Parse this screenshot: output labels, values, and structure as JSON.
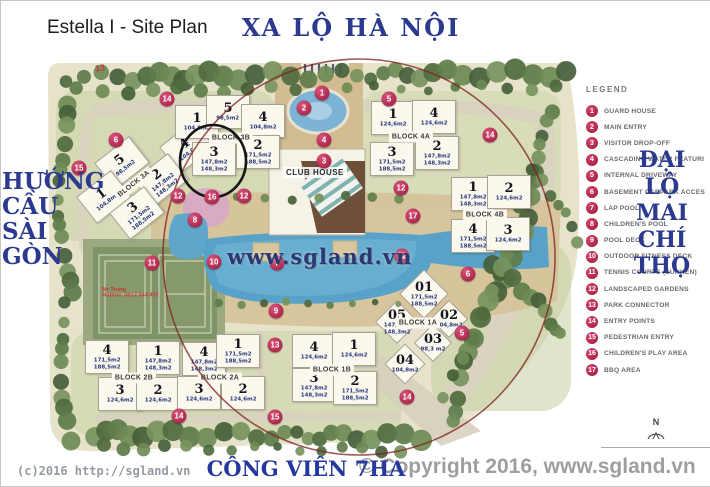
{
  "header": {
    "title": "Estella I - Site Plan",
    "road_top": "XA LỘ HÀ NỘI"
  },
  "sides": {
    "left_lines": [
      "HƯỚNG",
      "CẦU",
      "SÀI",
      "GÒN"
    ],
    "right_lines": [
      "ĐẠI",
      "LỘ",
      "MAI",
      "CHÍ",
      "THỌ"
    ]
  },
  "legend": {
    "title": "LEGEND",
    "items": [
      {
        "num": "1",
        "label": "GUARD HOUSE"
      },
      {
        "num": "2",
        "label": "MAIN ENTRY"
      },
      {
        "num": "3",
        "label": "VISITOR DROP-OFF"
      },
      {
        "num": "4",
        "label": "CASCADING WATER FEATURI"
      },
      {
        "num": "5",
        "label": "INTERNAL DRIVEWAY"
      },
      {
        "num": "6",
        "label": "BASEMENT CARPARK ACCES"
      },
      {
        "num": "7",
        "label": "LAP POOL"
      },
      {
        "num": "8",
        "label": "CHILDREN'S POOL"
      },
      {
        "num": "9",
        "label": "POOL DECK"
      },
      {
        "num": "10",
        "label": "OUTDOOR FITNESS DECK"
      },
      {
        "num": "11",
        "label": "TENNIS COURTS (SUNKEN)"
      },
      {
        "num": "12",
        "label": "LANDSCAPED GARDENS"
      },
      {
        "num": "13",
        "label": "PARK CONNECTOR"
      },
      {
        "num": "14",
        "label": "ENTRY POINTS"
      },
      {
        "num": "15",
        "label": "PEDESTRIAN ENTRY"
      },
      {
        "num": "16",
        "label": "CHILDREN'S PLAY AREA"
      },
      {
        "num": "17",
        "label": "BBQ AREA"
      }
    ]
  },
  "map": {
    "clubhouse_label": "CLUB HOUSE",
    "watermark": "www.sgland.vn",
    "stray_mark": "13",
    "agent_note": {
      "line1": "Mr Trung",
      "line2": "Hotline: 0913 944 457"
    },
    "blocks": [
      {
        "name": "BLOCK 3A",
        "label_pos": [
          133,
          183
        ],
        "rot": -38,
        "units": [
          {
            "n": "4",
            "areas": [
              "104,8m2"
            ],
            "pos": [
              186,
              146
            ]
          },
          {
            "n": "5",
            "areas": [
              "98,5m2"
            ],
            "pos": [
              121,
              162
            ]
          },
          {
            "n": "2",
            "areas": [
              "147,8m2",
              "148,3m2"
            ],
            "pos": [
              160,
              179
            ]
          },
          {
            "n": "1",
            "areas": [
              "104,8m2"
            ],
            "pos": [
              103,
              196
            ]
          },
          {
            "n": "3",
            "areas": [
              "171,5m2",
              "188,5m2"
            ],
            "pos": [
              136,
              212
            ]
          }
        ]
      },
      {
        "name": "BLOCK 3B",
        "label_pos": [
          230,
          137
        ],
        "units": [
          {
            "n": "1",
            "areas": [
              "104,8m2"
            ],
            "pos": [
              196,
              121
            ]
          },
          {
            "n": "5",
            "areas": [
              "98,5m2"
            ],
            "pos": [
              227,
              111
            ]
          },
          {
            "n": "4",
            "areas": [
              "104,8m2"
            ],
            "pos": [
              262,
              120
            ]
          },
          {
            "n": "3",
            "areas": [
              "147,8m2",
              "148,3m2"
            ],
            "pos": [
              213,
              158
            ]
          },
          {
            "n": "2",
            "areas": [
              "171,5m2",
              "188,5m2"
            ],
            "pos": [
              257,
              151
            ]
          }
        ]
      },
      {
        "name": "BLOCK 4A",
        "label_pos": [
          410,
          136
        ],
        "units": [
          {
            "n": "1",
            "areas": [
              "124,6m2"
            ],
            "pos": [
              392,
              117
            ]
          },
          {
            "n": "4",
            "areas": [
              "124,6m2"
            ],
            "pos": [
              433,
              116
            ]
          },
          {
            "n": "3",
            "areas": [
              "171,5m2",
              "188,5m2"
            ],
            "pos": [
              391,
              158
            ]
          },
          {
            "n": "2",
            "areas": [
              "147,8m2",
              "148,3m2"
            ],
            "pos": [
              436,
              152
            ]
          }
        ]
      },
      {
        "name": "BLOCK 4B",
        "label_pos": [
          484,
          214
        ],
        "units": [
          {
            "n": "1",
            "areas": [
              "147,8m2",
              "148,3m2"
            ],
            "pos": [
              472,
              193
            ]
          },
          {
            "n": "2",
            "areas": [
              "124,6m2"
            ],
            "pos": [
              508,
              191
            ]
          },
          {
            "n": "4",
            "areas": [
              "171,5m2",
              "188,5m2"
            ],
            "pos": [
              472,
              235
            ]
          },
          {
            "n": "3",
            "areas": [
              "124,6m2"
            ],
            "pos": [
              507,
              233
            ]
          }
        ]
      },
      {
        "name": "BLOCK 2B",
        "label_pos": [
          133,
          377
        ],
        "units": [
          {
            "n": "4",
            "areas": [
              "171,5m2",
              "188,5m2"
            ],
            "pos": [
              106,
              356
            ]
          },
          {
            "n": "1",
            "areas": [
              "147,8m2",
              "148,3m2"
            ],
            "pos": [
              157,
              357
            ]
          },
          {
            "n": "3",
            "areas": [
              "124,6m2"
            ],
            "pos": [
              119,
              393
            ]
          },
          {
            "n": "2",
            "areas": [
              "124,6m2"
            ],
            "pos": [
              157,
              393
            ]
          }
        ]
      },
      {
        "name": "BLOCK 2A",
        "label_pos": [
          219,
          377
        ],
        "units": [
          {
            "n": "4",
            "areas": [
              "147,8m2",
              "148,3m2"
            ],
            "pos": [
              203,
              358
            ]
          },
          {
            "n": "1",
            "areas": [
              "171,5m2",
              "188,5m2"
            ],
            "pos": [
              237,
              350
            ]
          },
          {
            "n": "3",
            "areas": [
              "124,6m2"
            ],
            "pos": [
              198,
              392
            ]
          },
          {
            "n": "2",
            "areas": [
              "124,6m2"
            ],
            "pos": [
              242,
              392
            ]
          }
        ]
      },
      {
        "name": "BLOCK 1B",
        "label_pos": [
          331,
          369
        ],
        "units": [
          {
            "n": "4",
            "areas": [
              "124,6m2"
            ],
            "pos": [
              313,
              350
            ]
          },
          {
            "n": "1",
            "areas": [
              "124,6m2"
            ],
            "pos": [
              353,
              348
            ]
          },
          {
            "n": "3",
            "areas": [
              "147,8m2",
              "148,3m2"
            ],
            "pos": [
              313,
              384
            ]
          },
          {
            "n": "2",
            "areas": [
              "171,5m2",
              "188,5m2"
            ],
            "pos": [
              354,
              387
            ]
          }
        ]
      },
      {
        "name": "BLOCK 1A",
        "label_pos": [
          417,
          322
        ],
        "boxless": true,
        "units": [
          {
            "n": "01",
            "areas": [
              "171,5m2",
              "188,5m2"
            ],
            "pos": [
              423,
              293
            ]
          },
          {
            "n": "05",
            "areas": [
              "147,8m2",
              "148,3m2"
            ],
            "pos": [
              396,
              321
            ]
          },
          {
            "n": "02",
            "areas": [
              "104,8m2"
            ],
            "pos": [
              448,
              318
            ]
          },
          {
            "n": "03",
            "areas": [
              "98,3 m2"
            ],
            "pos": [
              432,
              342
            ]
          },
          {
            "n": "04",
            "areas": [
              "104,8m2"
            ],
            "pos": [
              404,
              363
            ]
          }
        ]
      }
    ],
    "markers": [
      {
        "num": "1",
        "pos": [
          321,
          92
        ]
      },
      {
        "num": "2",
        "pos": [
          303,
          107
        ]
      },
      {
        "num": "4",
        "pos": [
          323,
          139
        ]
      },
      {
        "num": "3",
        "pos": [
          323,
          160
        ]
      },
      {
        "num": "5",
        "pos": [
          388,
          98
        ]
      },
      {
        "num": "14",
        "pos": [
          166,
          98
        ]
      },
      {
        "num": "6",
        "pos": [
          115,
          139
        ]
      },
      {
        "num": "14",
        "pos": [
          489,
          134
        ]
      },
      {
        "num": "12",
        "pos": [
          177,
          195
        ]
      },
      {
        "num": "16",
        "pos": [
          211,
          196
        ]
      },
      {
        "num": "12",
        "pos": [
          243,
          195
        ]
      },
      {
        "num": "12",
        "pos": [
          400,
          187
        ]
      },
      {
        "num": "8",
        "pos": [
          194,
          219
        ]
      },
      {
        "num": "17",
        "pos": [
          412,
          215
        ]
      },
      {
        "num": "11",
        "pos": [
          151,
          262
        ]
      },
      {
        "num": "10",
        "pos": [
          213,
          261
        ]
      },
      {
        "num": "7",
        "pos": [
          276,
          262
        ]
      },
      {
        "num": "12",
        "pos": [
          401,
          255
        ]
      },
      {
        "num": "9",
        "pos": [
          275,
          310
        ]
      },
      {
        "num": "13",
        "pos": [
          274,
          344
        ]
      },
      {
        "num": "6",
        "pos": [
          467,
          273
        ]
      },
      {
        "num": "5",
        "pos": [
          461,
          332
        ]
      },
      {
        "num": "14",
        "pos": [
          406,
          396
        ]
      },
      {
        "num": "14",
        "pos": [
          178,
          415
        ]
      },
      {
        "num": "15",
        "pos": [
          274,
          416
        ]
      },
      {
        "num": "15",
        "pos": [
          78,
          167
        ]
      }
    ]
  },
  "footer": {
    "watermark_left": "(c)2016 http://sgland.vn",
    "park_label": "CÔNG VIÊN 7HA",
    "copyright": "© Copyright 2016, www.sgland.vn",
    "compass": "N"
  },
  "colors": {
    "navy": "#2b3a8f",
    "marker_red": "#b82e52",
    "pool_blue": "#58a2c9",
    "annotation_red": "#7e2020"
  }
}
